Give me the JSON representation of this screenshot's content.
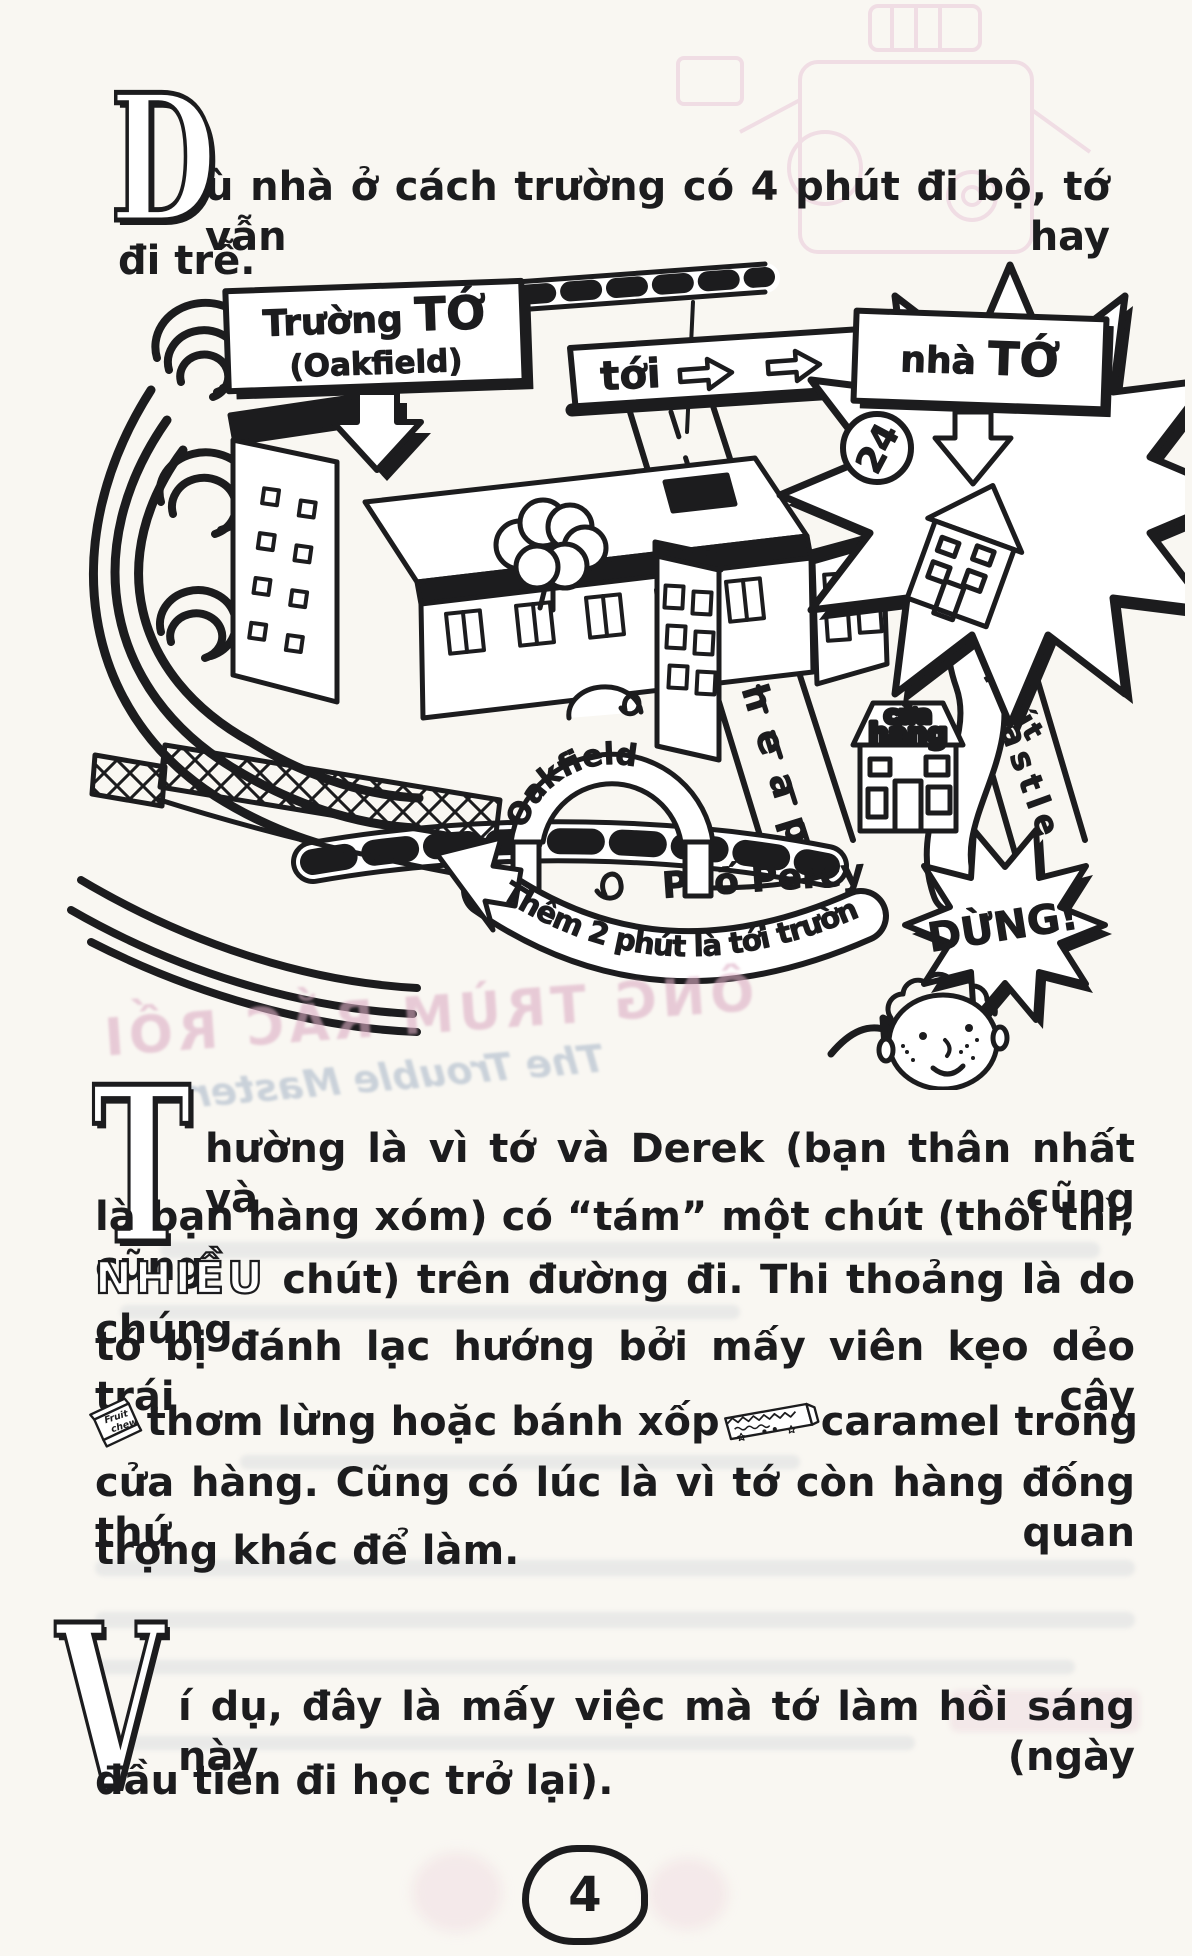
{
  "page": {
    "background": "#f9f7f2",
    "ink": "#1c1c1e",
    "number": "4"
  },
  "para1": {
    "dropcap": "D",
    "line1": "ù nhà ở cách trường có 4 phút đi bộ, tớ vẫn hay",
    "line2": "đi trễ."
  },
  "para2": {
    "dropcap": "T",
    "line1": "hường là vì tớ và Derek (bạn thân nhất và cũng",
    "line2": "là bạn hàng xóm) có “tám” một chút (thôi thì, cũng",
    "line3_emphasis": "NHIỀU",
    "line3_rest": "chút) trên đường đi. Thi thoảng là do chúng",
    "line4": "tớ bị đánh lạc hướng bởi mấy viên kẹo dẻo trái cây",
    "line5_a": "thơm lừng hoặc bánh xốp",
    "line5_b": "caramel trong",
    "line6": "cửa hàng. Cũng có lúc là vì tớ còn hàng đống thứ quan",
    "line7": "trọng khác để làm."
  },
  "para3": {
    "dropcap": "V",
    "line1": "í dụ, đây là mấy việc mà tớ làm hồi sáng này (ngày",
    "line2": "đầu tiên đi học trở lại)."
  },
  "map": {
    "school_sign_a": "Trường",
    "school_sign_b": "TỚ",
    "school_sign_sub": "(Oakfield)",
    "toi": "tới",
    "home_sign_a": "nhà",
    "home_sign_b": "TỚ",
    "house_number": "24",
    "street_cheap": "Phố Cheap",
    "street_castle": "Đường Castle",
    "route_time": "Hai phút",
    "shop_a": "cửa",
    "shop_b": "hàng",
    "gate": "Oakfield",
    "street_percy": "Phố Percy",
    "banner": "Thêm 2 phút là tới trường",
    "stop": "DỪNG!"
  },
  "icons": {
    "fruit_chew_a": "Fruit",
    "fruit_chew_b": "chew"
  },
  "bleed": {
    "title": "ÔNG TRÙM RẮC RỐI",
    "subtitle": "The Trouble Master"
  }
}
